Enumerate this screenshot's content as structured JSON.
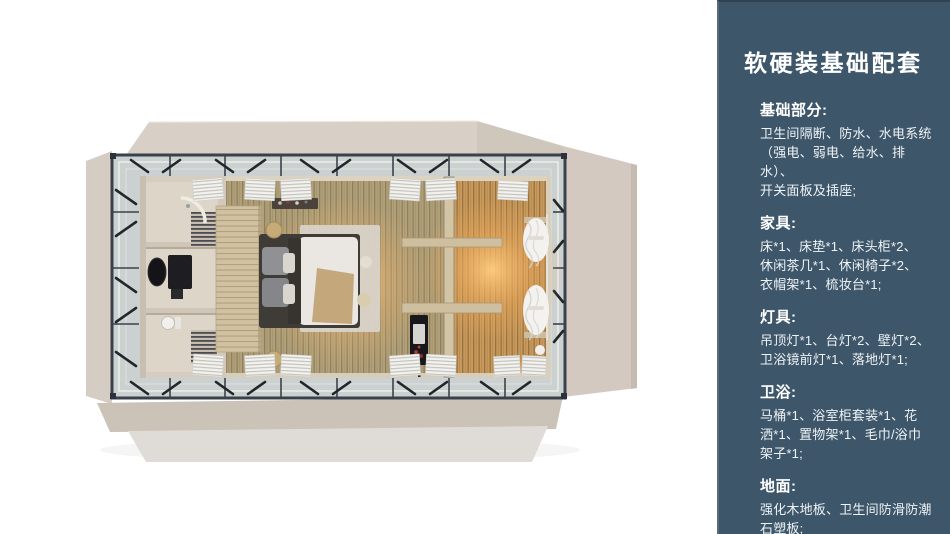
{
  "page": {
    "background": "#ffffff"
  },
  "sidebar": {
    "background_color": "#3E566A",
    "title": "软硬装基础配套",
    "sections": [
      {
        "heading": "基础部分:",
        "body": "卫生间隔断、防水、水电系统\n（强电、弱电、给水、排水）、\n开关面板及插座;"
      },
      {
        "heading": "家具:",
        "body": "床*1、床垫*1、床头柜*2、\n休闲茶几*1、休闲椅子*2、\n衣帽架*1、梳妆台*1;"
      },
      {
        "heading": "灯具:",
        "body": "吊顶灯*1、台灯*2、壁灯*2、\n卫浴镜前灯*1、落地灯*1;"
      },
      {
        "heading": "卫浴:",
        "body": "马桶*1、浴室柜套装*1、花\n洒*1、置物架*1、毛巾/浴巾\n架子*1;"
      },
      {
        "heading": "地面:",
        "body": "强化木地板、卫生间防滑防潮\n石塑板;"
      }
    ]
  },
  "floorplan": {
    "palette": {
      "exterior_panel": "#D6CDC4",
      "steel_frame": "#3A424B",
      "deck_glass": "#CBD1D0",
      "wood_floor": "#B2A27B",
      "warm_light": "#E8A95F",
      "bathroom_wall": "#D5CDC0",
      "bed_duvet": "#EAE7E2"
    }
  }
}
